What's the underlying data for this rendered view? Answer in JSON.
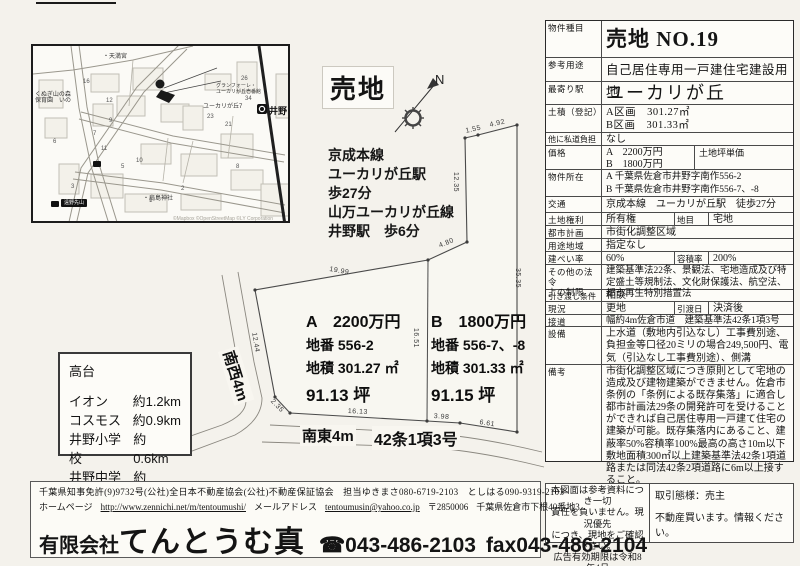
{
  "stamp": "売地",
  "compass": {
    "n": "N"
  },
  "access": {
    "lines": [
      "京成本線",
      "ユーカリが丘駅",
      "歩27分",
      "山万ユーカリが丘線",
      "井野駅　歩6分"
    ]
  },
  "map": {
    "station": "井野",
    "labels": {
      "tenmangu": "・天満宮",
      "nursery": "くぬぎ山の森\n保育園　いの",
      "granforet": "グランフォーレ・\nユーカリが丘壱番館",
      "yukarigaoka7": "ユーカリが丘7",
      "shrine": "・扇島神社",
      "busstop": "遠野先山"
    },
    "attribution": "©Mapbox ©OpenStreetMap ©LY Corporation",
    "block_numbers": [
      "16",
      "12",
      "9",
      "7",
      "11",
      "6",
      "5",
      "3",
      "10",
      "23",
      "21",
      "34",
      "8",
      "1",
      "2",
      "26"
    ]
  },
  "plot": {
    "dimensions": [
      "1.55",
      "4.92",
      "12.35",
      "4.80",
      "19.99",
      "12.44",
      "2.35",
      "16.13",
      "3.98",
      "6.61",
      "35.35",
      "16.51"
    ],
    "road_sw": "南西4m",
    "road_se": "南東4m",
    "road_article": "42条1項3号",
    "parcel_a": {
      "price": "A　2200万円",
      "lot": "地番 556-2",
      "area": "地積 301.27 ㎡",
      "tsubo": "91.13 坪"
    },
    "parcel_b": {
      "price": "B　1800万円",
      "lot": "地番 556-7、-8",
      "area": "地積 301.33 ㎡",
      "tsubo": "91.15 坪"
    }
  },
  "landmarks": {
    "title": "高台",
    "items": [
      {
        "name": "イオン",
        "distance": "約1.2km"
      },
      {
        "name": "コスモス",
        "distance": "約0.9km"
      },
      {
        "name": "井野小学校",
        "distance": "約0.6km"
      },
      {
        "name": "井野中学校",
        "distance": "約1.4km"
      }
    ]
  },
  "table": {
    "rows": [
      {
        "label": "物件種目",
        "value": "売地 NO.19"
      },
      {
        "label": "参考用途",
        "value": "自己居住専用一戸建住宅建設用地"
      },
      {
        "label": "最寄り駅",
        "value": "ユーカリが丘"
      },
      {
        "label": "土積（登記）",
        "value": "A区画　301.27㎡\nB区画　301.33㎡"
      },
      {
        "label": "他に私道負担",
        "value": "なし"
      },
      {
        "label": "価格",
        "value": "A　2200万円\nB　1800万円",
        "label2": "土地坪単価",
        "value2": ""
      },
      {
        "label": "物件所在",
        "value": "A 千葉県佐倉市井野字南作556-2\nB 千葉県佐倉市井野字南作556-7、-8"
      },
      {
        "label": "交通",
        "value": "京成本線　ユーカリが丘駅　徒歩27分"
      },
      {
        "label": "土地権利",
        "value": "所有権",
        "label2": "地目",
        "value2": "宅地"
      },
      {
        "label": "都市計画",
        "value": "市街化調整区域"
      },
      {
        "label": "用途地域",
        "value": "指定なし"
      },
      {
        "label": "建ぺい率",
        "value": "60%",
        "label2": "容積率",
        "value2": "200%"
      },
      {
        "label": "その他の法令\n上の制限",
        "value": "建築基準法22条、景観法、宅地造成及び特定盛土等規制法、文化財保護法、航空法、都市再生特別措置法"
      },
      {
        "label": "引き渡し条件",
        "value": "相談"
      },
      {
        "label": "現況",
        "value": "更地",
        "label2": "引渡日",
        "value2": "決済後"
      },
      {
        "label": "接道",
        "value": "幅約4m佐倉市道　建築基準法42条1項3号"
      },
      {
        "label": "設備",
        "value": "上水道（敷地内引込なし）工事費別途、負担金等口径20ミリの場合249,500円、電気（引込なし工事費別途）、側溝"
      },
      {
        "label": "備考",
        "value": "市街化調整区域につき原則として宅地の造成及び建物建築ができません。佐倉市条例の「条例による既存集落」に適合し都市計画法29条の開発許可を受けることができれば自己居住専用一戸建て住宅の建築が可能。既存集落内にあること、建蔽率50%容積率100%最高の高さ10m以下敷地面積300㎡以上建築基準法42条1項道路または同法42条2項道路に6m以上接すること。"
      }
    ]
  },
  "notice": {
    "left": "本図面は参考資料につき一切\n責任を負いません。現況優先\nにつき、現地をご確認下さい。\n広告有効期限は令和8年4月\n末日迄とします。",
    "right_top": "取引態様：売主",
    "right_bottom": "不動産買います。情報ください。"
  },
  "company": {
    "license_line": "千葉県知事免許(9)9732号(公社)全日本不動産協会(公社)不動産保証協会　担当ゆきまさ080-6719-2103　としはる090-9319-2103",
    "homepage_label": "ホームページ",
    "homepage_url": "http://www.zennichi.net/m/tentoumushi/",
    "mail_label": "メールアドレス",
    "mail_addr": "tentoumusin@yahoo.co.jp",
    "postal": "〒2850006",
    "address": "千葉県佐倉市下根40番地3",
    "name_prefix": "有限会社",
    "name": "てんとうむ真",
    "tel": "☎043-486-2103",
    "fax": "fax043-486-2104"
  }
}
